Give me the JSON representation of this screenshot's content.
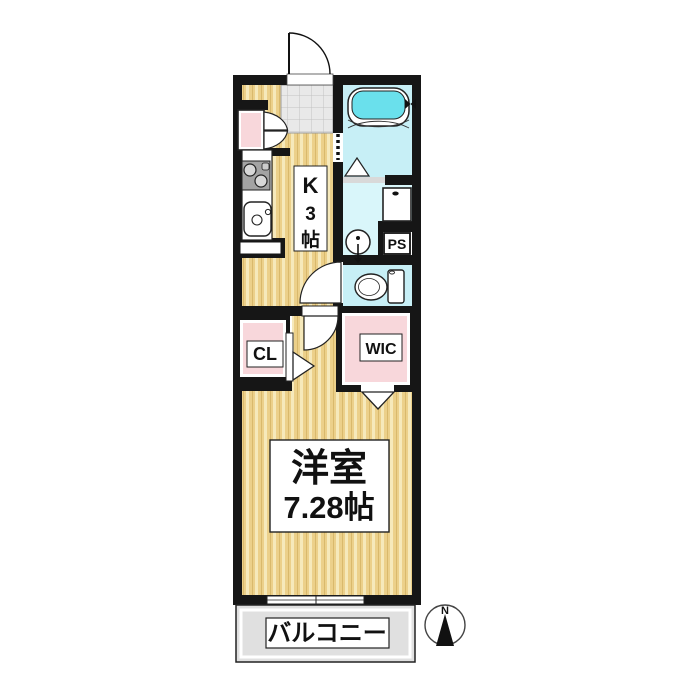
{
  "labels": {
    "kitchen": {
      "text": "K3帖",
      "chars": [
        "K",
        "3",
        "帖"
      ]
    },
    "closet": "CL",
    "walk_in_closet": "WIC",
    "pipe_space": "PS",
    "western_room_name": "洋室",
    "western_room_size": "7.28帖",
    "balcony": "バルコニー",
    "compass_north": "N"
  },
  "rooms": [
    {
      "name": "kitchen",
      "label": "K3帖"
    },
    {
      "name": "bathroom",
      "label": ""
    },
    {
      "name": "washroom",
      "label": ""
    },
    {
      "name": "toilet",
      "label": ""
    },
    {
      "name": "closet",
      "label": "CL"
    },
    {
      "name": "walk-in-closet",
      "label": "WIC"
    },
    {
      "name": "pipe-space",
      "label": "PS"
    },
    {
      "name": "western-room",
      "label": "洋室 7.28帖"
    },
    {
      "name": "balcony",
      "label": "バルコニー"
    }
  ],
  "icons": {
    "compass_rose": "circle-with-north-needle",
    "entrance_door": "quarter-arc-swing",
    "bathtub": "rounded-rect-tub-with-faucet",
    "toilet": "bowl-and-tank-side-view",
    "washbasin": "circle-with-stem",
    "washing_machine": "square-with-faucet-dot",
    "stove": "two-burner-cooktop",
    "kitchen_sink": "rounded-square-with-drain",
    "shoe_cabinet_doors": "double-swing-doors",
    "door_swing_marks": "triangles-and-quarter-circles",
    "window": "double-line-sash"
  },
  "colors": {
    "wall": "#161616",
    "floor_base": "#ecd08a",
    "floor_stripe": "#f6e9bb",
    "genkan_tile": "#e9e9e9",
    "bath_floor": "#c7eff6",
    "bathtub_water": "#6ae0ec",
    "washroom_floor": "#d9f6fa",
    "toilet_floor": "#c7eff6",
    "closet_pink": "#f8d7db",
    "balcony_gray": "#e0e0e0",
    "label_box": "#ffffff"
  }
}
